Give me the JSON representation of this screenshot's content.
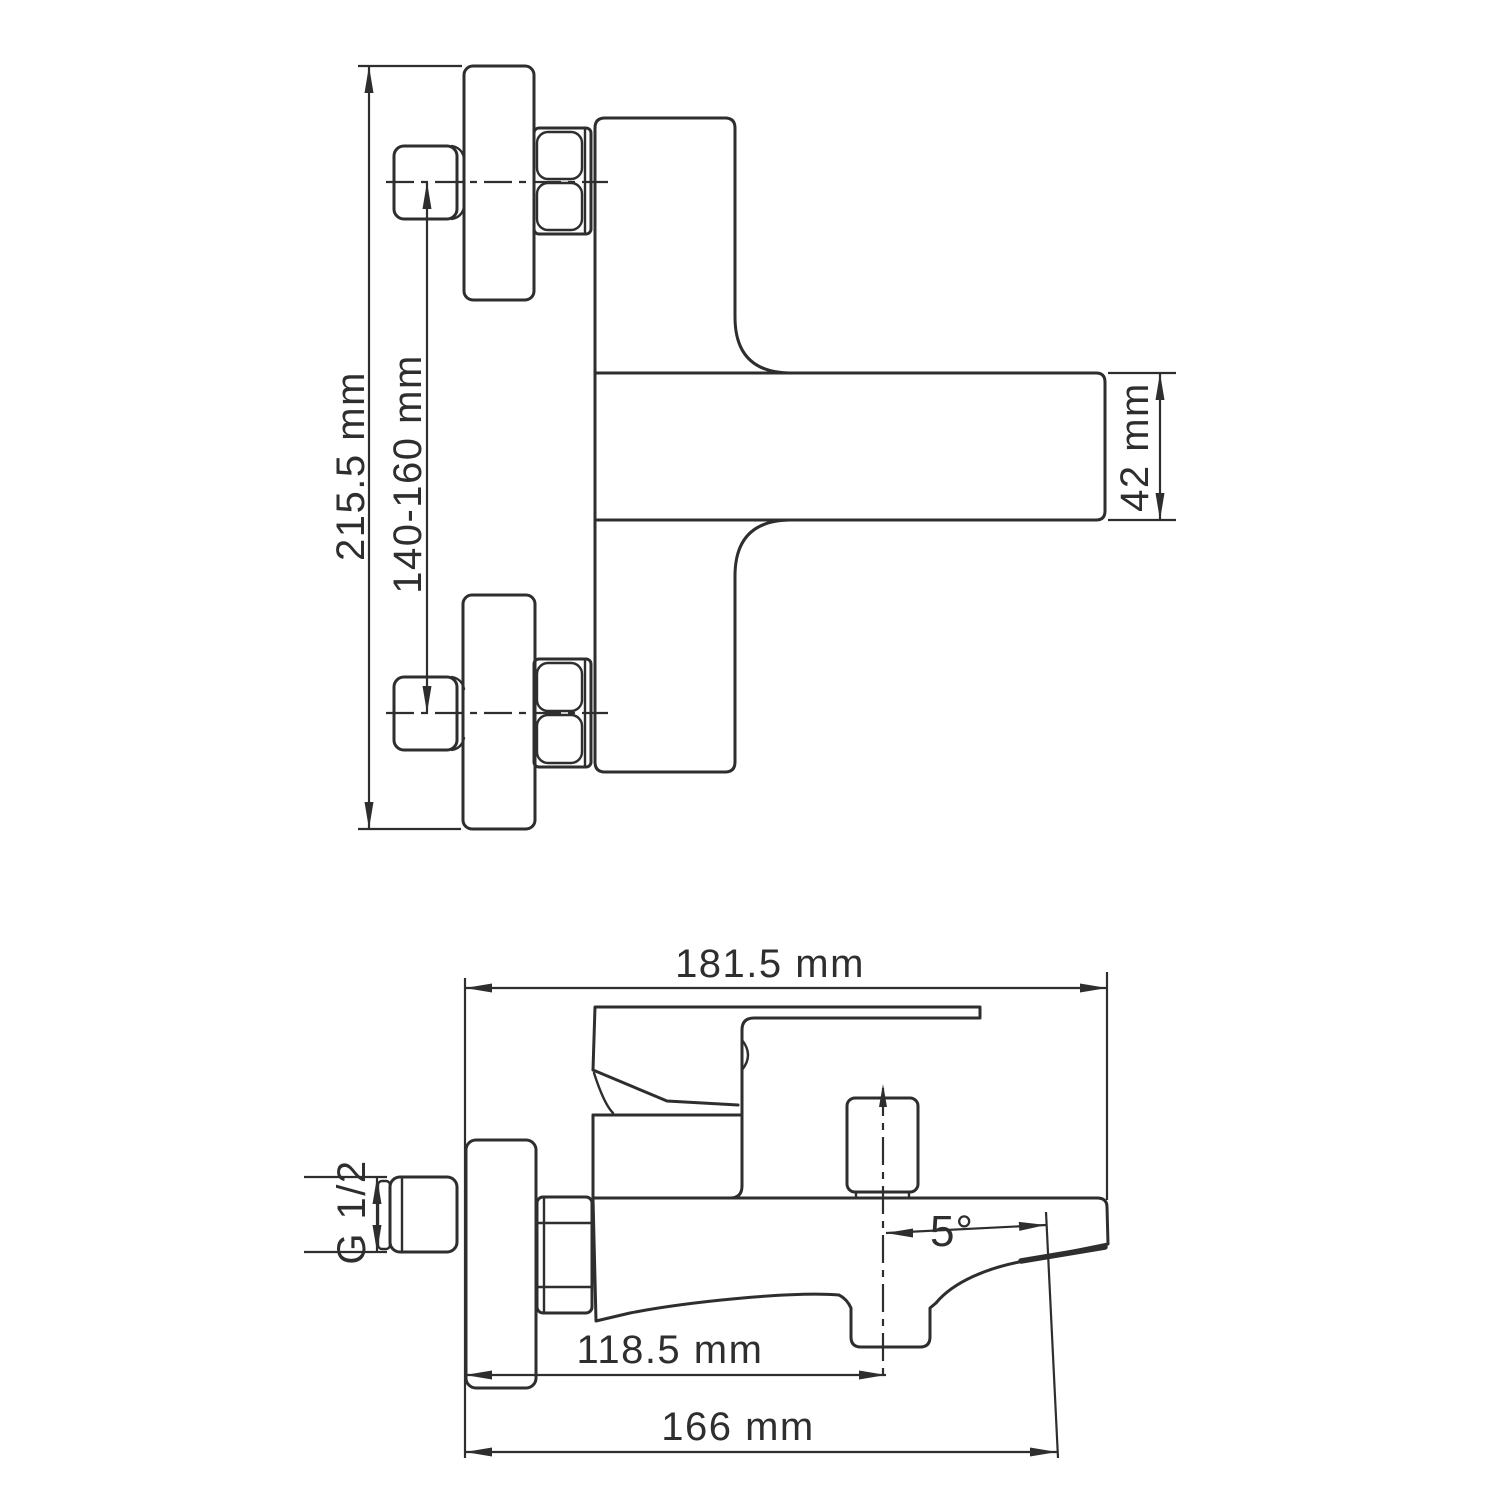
{
  "drawing": {
    "background": "#ffffff",
    "line_color": "#2e2e2e",
    "front_view": {
      "overall_height": "215.5 mm",
      "wall_inlet_spacing": "140-160 mm",
      "spout_height": "42 mm"
    },
    "side_view": {
      "overall_length": "181.5 mm",
      "thread_size": "G 1/2",
      "spout_center_distance": "118.5 mm",
      "spout_tip_distance": "166 mm",
      "spout_angle": "5°"
    }
  }
}
